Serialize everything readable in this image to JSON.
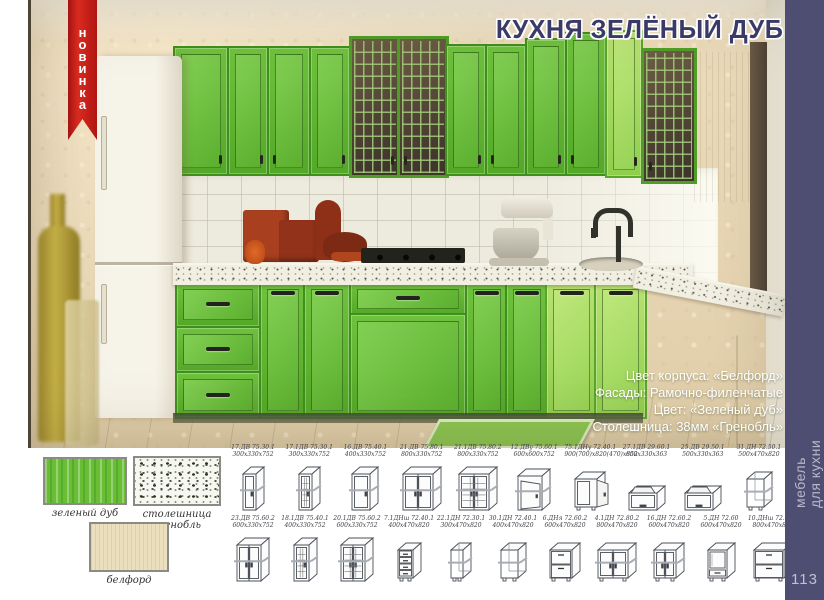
{
  "page": {
    "number": "113",
    "side_text": [
      "мебель",
      "для кухни"
    ]
  },
  "ribbon": {
    "label": "новинка"
  },
  "title": "КУХНЯ ЗЕЛЁНЫЙ ДУБ",
  "specs": [
    "Цвет корпуса: «Белфорд»",
    "Фасады: Рамочно-филенчатые",
    "Цвет: «Зеленый дуб»",
    "Столешница: 38мм «Гренобль»"
  ],
  "swatches": [
    {
      "label": "зеленый дуб"
    },
    {
      "label": "столешница гренобль"
    },
    {
      "label": "белфорд"
    }
  ],
  "catalog_rows": [
    [
      {
        "code": "17.ДВ 75.30.1",
        "dims": "300x330x752",
        "type": "wall-door1-narrow"
      },
      {
        "code": "17.1ДВ 75.30.1",
        "dims": "300x330x752",
        "type": "wall-glass1-narrow"
      },
      {
        "code": "16.ДВ 75.40.1",
        "dims": "400x330x752",
        "type": "wall-door1"
      },
      {
        "code": "21.ДВ 75.80.1",
        "dims": "800x330x752",
        "type": "wall-door2-wide"
      },
      {
        "code": "21.1ДВ 75.80.2",
        "dims": "800x330x752",
        "type": "wall-glass2-wide"
      },
      {
        "code": "12.ДВу 75.60.1",
        "dims": "600x600x752",
        "type": "wall-corner"
      },
      {
        "code": "75.1ДНу 72.40.1",
        "dims": "900(700)x820(470)x852",
        "type": "base-corner"
      },
      {
        "code": "27.1ДВ 29.60.1",
        "dims": "600x330x363",
        "type": "wall-flip"
      },
      {
        "code": "25.ДВ 29.50.1",
        "dims": "500x330x363",
        "type": "wall-flip"
      },
      {
        "code": "31.ДН 72.50.1",
        "dims": "500x470x820",
        "type": "base-open"
      }
    ],
    [
      {
        "code": "23.ДВ 75.60.2",
        "dims": "600x330x752",
        "type": "wall-door2"
      },
      {
        "code": "18.1ДВ 75.40.1",
        "dims": "400x330x752",
        "type": "wall-glass1"
      },
      {
        "code": "20.1ДВ 75.60.2",
        "dims": "600x330x752",
        "type": "wall-glass2"
      },
      {
        "code": "7.1ДНш 72.40.1",
        "dims": "400x470x820",
        "type": "base-drawers4"
      },
      {
        "code": "22.1ДН 72.30.1",
        "dims": "300x470x820",
        "type": "base-open-narrow"
      },
      {
        "code": "30.1ДН 72.40.1",
        "dims": "400x470x820",
        "type": "base-open"
      },
      {
        "code": "6.ДНя 72.60.2",
        "dims": "600x470x820",
        "type": "base-drawers2"
      },
      {
        "code": "4.1ДН 72.80.2",
        "dims": "800x470x820",
        "type": "base-door2-wide"
      },
      {
        "code": "16.ДН 72.60.2",
        "dims": "600x470x820",
        "type": "base-door2"
      },
      {
        "code": "5.ДН 72.60",
        "dims": "600x470x820",
        "type": "base-oven"
      },
      {
        "code": "10.ДНш 72.80.2",
        "dims": "800x470x820",
        "type": "base-drawers2-wide"
      }
    ]
  ],
  "colors": {
    "sidebar_navy": "#4e4e73",
    "ribbon_red": "#c42018",
    "title_navy": "#3a3a68",
    "green_oak": "#69be36",
    "belford": "#ecdfbd",
    "countertop_grenoble": "#f1eee2"
  }
}
